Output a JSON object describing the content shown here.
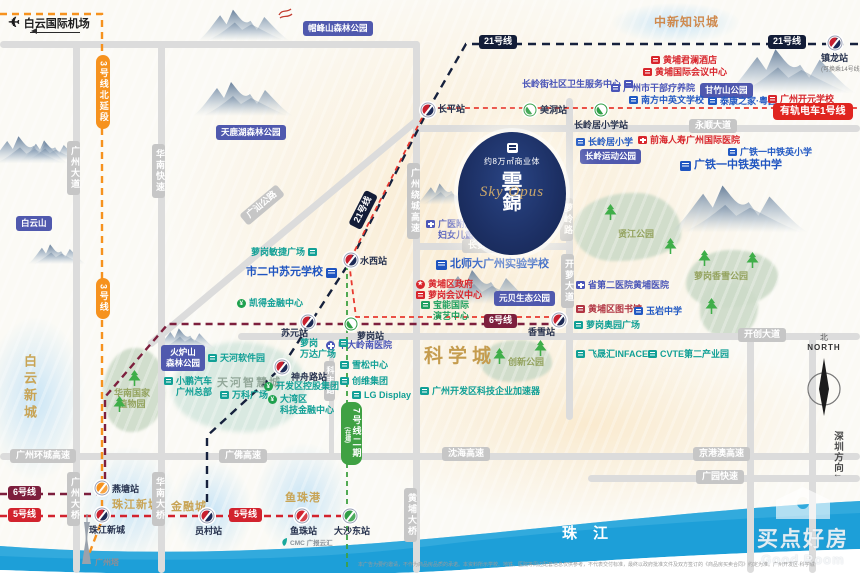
{
  "project": {
    "badge": "约8万㎡商业体",
    "name_line1": "雲",
    "name_line2": "錦",
    "name_en": "Sky Opus"
  },
  "airport": {
    "label": "白云国际机场"
  },
  "river": {
    "label": "珠江"
  },
  "compass": {
    "cn": "北",
    "en": "NORTH"
  },
  "tower": {
    "label": "广州塔"
  },
  "cmc": {
    "label": "CMC 广报云汇"
  },
  "watermark": {
    "cn": "买点好房",
    "en": "Good Room"
  },
  "disclaimer": {
    "text": "本广告为要约邀请，不作为商品房品质的承诺。本资料所示学校、地铁、医院等周边配套信息仅供参考，不代表交付标准，最终以政府批准文件及双方签订的《商品房买卖合同》约定为准。广州开发区·科学城"
  },
  "metro_lines": [
    {
      "id": "line3",
      "color": "#f6921e",
      "width": 2.4,
      "dash": "7 5",
      "points": "0,14 102,14 102,520 88,557"
    },
    {
      "id": "line6",
      "color": "#7d1f3d",
      "width": 2.4,
      "dash": "7 5",
      "points": "0,494 105,494 105,397 168,324 558,324"
    },
    {
      "id": "line5",
      "color": "#d2232e",
      "width": 2.4,
      "dash": "7 5",
      "points": "0,516 356,516"
    },
    {
      "id": "line21",
      "color": "#16213d",
      "width": 2.4,
      "dash": "8 6",
      "points": "207,516 207,436 282,367 351,260 428,110 466,44 860,44"
    },
    {
      "id": "tram1",
      "color": "#e8392f",
      "width": 1.8,
      "dash": "5 4",
      "points": "558,317 356,317 349,262 427,108 860,108"
    },
    {
      "id": "line7",
      "color": "#3fa143",
      "width": 1.8,
      "dash": "5 4",
      "points": "347,256 347,570"
    }
  ],
  "line_badges": [
    {
      "cls": "b3 vert",
      "x": 96,
      "y": 55,
      "label": "3号线北延段"
    },
    {
      "cls": "b3 vert",
      "x": 96,
      "y": 278,
      "label": "3号线"
    },
    {
      "cls": "b21",
      "x": 479,
      "y": 35,
      "label": "21号线"
    },
    {
      "cls": "b21",
      "x": 768,
      "y": 35,
      "label": "21号线"
    },
    {
      "cls": "b21",
      "x": 344,
      "y": 203,
      "label": "21号线",
      "rot": -63
    },
    {
      "cls": "b6",
      "x": 8,
      "y": 486,
      "label": "6号线"
    },
    {
      "cls": "b6",
      "x": 484,
      "y": 314,
      "label": "6号线"
    },
    {
      "cls": "b5",
      "x": 8,
      "y": 508,
      "label": "5号线"
    },
    {
      "cls": "b5",
      "x": 229,
      "y": 508,
      "label": "5号线"
    },
    {
      "cls": "btram",
      "x": 773,
      "y": 103,
      "label": "有轨电车1号线"
    },
    {
      "cls": "b7 vert",
      "x": 341,
      "y": 402,
      "label": "7号线二期",
      "label2": "(在建)"
    }
  ],
  "stations": [
    {
      "cls": "st-m",
      "x": 428,
      "y": 110,
      "label": "长平站",
      "ldx": 10,
      "ldy": -8,
      "fs": 10
    },
    {
      "cls": "st-tram",
      "x": 530,
      "y": 110,
      "label": "美洞站",
      "ldx": 10,
      "ldy": -7
    },
    {
      "cls": "st-tram",
      "x": 601,
      "y": 110,
      "label": "长岭居小学站",
      "ldx": -27,
      "ldy": 8
    },
    {
      "cls": "st-m",
      "x": 835,
      "y": 43,
      "label": "镇龙站",
      "label2": "(可换乘14号线)",
      "ldx": -14,
      "ldy": 8
    },
    {
      "cls": "st-m",
      "x": 351,
      "y": 260,
      "label": "水西站",
      "ldx": 9,
      "ldy": -6
    },
    {
      "cls": "st-m",
      "x": 308,
      "y": 322,
      "label": "苏元站",
      "ldx": -27,
      "ldy": 4
    },
    {
      "cls": "st-tram",
      "x": 351,
      "y": 324,
      "label": "萝岗站",
      "ldx": 6,
      "ldy": 5
    },
    {
      "cls": "st-m",
      "x": 559,
      "y": 320,
      "label": "香雪站",
      "ldx": -31,
      "ldy": 5
    },
    {
      "cls": "st-m",
      "x": 282,
      "y": 367,
      "label": "神舟路站",
      "ldx": 9,
      "ldy": 3
    },
    {
      "cls": "st-o",
      "x": 102,
      "y": 488,
      "label": "燕塘站",
      "ldx": 10,
      "ldy": -6
    },
    {
      "cls": "st-m",
      "x": 102,
      "y": 515,
      "label": "珠江新城",
      "ldx": -13,
      "ldy": 8
    },
    {
      "cls": "st-m",
      "x": 207,
      "y": 516,
      "label": "员村站",
      "ldx": -12,
      "ldy": 8
    },
    {
      "cls": "st-r",
      "x": 302,
      "y": 516,
      "label": "鱼珠站",
      "ldx": -12,
      "ldy": 8
    },
    {
      "cls": "st-g",
      "x": 350,
      "y": 516,
      "label": "大沙东站",
      "ldx": -16,
      "ldy": 8
    }
  ],
  "pois": [
    {
      "cls": "k-hosp ic-bld",
      "x": 522,
      "y": 79,
      "label": "长岭街社区卫生服务中心",
      "rev": 1
    },
    {
      "cls": "k-red ic-bld",
      "x": 651,
      "y": 55,
      "label": "黄埔君澜酒店"
    },
    {
      "cls": "k-red ic-bld",
      "x": 643,
      "y": 67,
      "label": "黄埔国际会议中心"
    },
    {
      "cls": "k-hosp ic-bld",
      "x": 611,
      "y": 83,
      "label": "广州市干部疗养院"
    },
    {
      "cls": "k-school ic-bld",
      "x": 629,
      "y": 95,
      "label": "南方中英文学校"
    },
    {
      "cls": "k-school ic-bld",
      "x": 708,
      "y": 96,
      "label": "泰康之家·粤园"
    },
    {
      "cls": "k-red ic-bld",
      "x": 768,
      "y": 94,
      "label": "广州开元学校"
    },
    {
      "cls": "k-school ic-bld",
      "x": 576,
      "y": 137,
      "label": "长岭居小学"
    },
    {
      "cls": "k-red ic-cross",
      "x": 638,
      "y": 135,
      "label": "前海人寿广州国际医院"
    },
    {
      "cls": "k-school ic-bld",
      "x": 728,
      "y": 147,
      "label": "广铁一中铁英小学"
    },
    {
      "cls": "k-school2 ic-bld",
      "x": 680,
      "y": 159,
      "label": "广铁一中铁英中学"
    },
    {
      "cls": "k-hosp ic-cross",
      "x": 426,
      "y": 219,
      "label": "广医附属",
      "label2": "妇女儿童医院"
    },
    {
      "cls": "k-school2 ic-bld",
      "x": 436,
      "y": 258,
      "label": "北师大广州实验学校"
    },
    {
      "cls": "k-biz ic-bld",
      "x": 251,
      "y": 247,
      "label": "萝岗敏捷广场",
      "rev": 1
    },
    {
      "cls": "k-school2 ic-bld",
      "x": 246,
      "y": 266,
      "label": "市二中苏元学校",
      "rev": 1
    },
    {
      "cls": "k-fin ic-yen",
      "x": 237,
      "y": 298,
      "label": "凯得金融中心"
    },
    {
      "cls": "k-red ic-star",
      "x": 416,
      "y": 279,
      "label": "黄埔区政府"
    },
    {
      "cls": "k-red ic-bld",
      "x": 416,
      "y": 290,
      "label": "萝岗会议中心"
    },
    {
      "cls": "k-green2 ic-bld",
      "x": 421,
      "y": 300,
      "label": "宝能国际",
      "label2": "演艺中心"
    },
    {
      "cls": "k-hosp ic-crossr",
      "x": 326,
      "y": 340,
      "label": "中大岭南医院"
    },
    {
      "cls": "k-biz ic-bld",
      "x": 340,
      "y": 360,
      "label": "雪松中心"
    },
    {
      "cls": "k-biz ic-bld",
      "x": 340,
      "y": 376,
      "label": "创维集团"
    },
    {
      "cls": "k-biz ic-bld",
      "x": 352,
      "y": 390,
      "label": "LG Display"
    },
    {
      "cls": "k-biz ic-bld",
      "x": 420,
      "y": 386,
      "label": "广州开发区科技企业加速器"
    },
    {
      "cls": "k-biz ic-bld",
      "x": 300,
      "y": 338,
      "label": "萝岗",
      "label2": "万达广场",
      "rev": 1
    },
    {
      "cls": "k-biz ic-bld",
      "x": 208,
      "y": 353,
      "label": "天河软件园"
    },
    {
      "cls": "k-biz ic-bld",
      "x": 164,
      "y": 376,
      "label": "小鹏汽车",
      "label2": "广州总部"
    },
    {
      "cls": "k-biz ic-bld",
      "x": 220,
      "y": 390,
      "label": "万科广场"
    },
    {
      "cls": "k-fin ic-yen",
      "x": 264,
      "y": 381,
      "label": "开发区控股集团"
    },
    {
      "cls": "k-fin ic-yen",
      "x": 268,
      "y": 394,
      "label": "大湾区",
      "label2": "科技金融中心"
    },
    {
      "cls": "k-hosp ic-cross",
      "x": 576,
      "y": 280,
      "label": "省第二医院黄埔医院"
    },
    {
      "cls": "k-lib ic-bld",
      "x": 576,
      "y": 304,
      "label": "黄埔区图书馆"
    },
    {
      "cls": "k-school ic-bld",
      "x": 634,
      "y": 306,
      "label": "玉岩中学"
    },
    {
      "cls": "k-biz ic-bld",
      "x": 574,
      "y": 320,
      "label": "萝岗奥园广场"
    },
    {
      "cls": "k-biz ic-bld",
      "x": 576,
      "y": 349,
      "label": "飞晟汇INFACE"
    },
    {
      "cls": "k-biz ic-bld",
      "x": 648,
      "y": 349,
      "label": "CVTE第二产业园"
    }
  ],
  "park_badges": [
    {
      "x": 303,
      "y": 21,
      "label": "帽峰山森林公园"
    },
    {
      "x": 216,
      "y": 125,
      "label": "天鹿湖森林公园"
    },
    {
      "x": 16,
      "y": 216,
      "label": "白云山"
    },
    {
      "x": 161,
      "y": 345,
      "label": "火炉山",
      "label2": "森林公园"
    },
    {
      "x": 700,
      "y": 83,
      "label": "甘竹山公园"
    },
    {
      "x": 580,
      "y": 149,
      "label": "长岭运动公园"
    },
    {
      "x": 494,
      "y": 291,
      "label": "元贝生态公园"
    }
  ],
  "park_labels": [
    {
      "x": 618,
      "y": 229,
      "label": "贤江公园"
    },
    {
      "x": 694,
      "y": 271,
      "label": "萝岗香雪公园"
    },
    {
      "x": 508,
      "y": 357,
      "label": "创新公园"
    },
    {
      "x": 114,
      "y": 388,
      "label": "华南国家",
      "label2": "植物园"
    }
  ],
  "regions": [
    {
      "x": 654,
      "y": 13,
      "label": "中新知识城",
      "fs": 12,
      "ls": 1,
      "color": "#cf8a4e"
    },
    {
      "x": 424,
      "y": 341,
      "label": "科学城",
      "fs": 19,
      "ls": 5,
      "color": "#c59c4e"
    },
    {
      "x": 20,
      "y": 354,
      "label": "白云新城",
      "fs": 13,
      "ls": 4,
      "color": "#c8a455",
      "cls": "vert"
    },
    {
      "x": 112,
      "y": 496,
      "label": "珠江新城",
      "fs": 11,
      "ls": 1,
      "color": "#c8a455"
    },
    {
      "x": 171,
      "y": 498,
      "label": "金融城",
      "fs": 11,
      "ls": 1,
      "color": "#c8a455"
    },
    {
      "x": 285,
      "y": 489,
      "label": "鱼珠港",
      "fs": 11,
      "ls": 1,
      "color": "#c8a455"
    },
    {
      "x": 217,
      "y": 374,
      "label": "天河智慧城",
      "fs": 11,
      "ls": 2,
      "color": "#93a89a"
    }
  ],
  "road_badges": [
    {
      "x": 689,
      "y": 119,
      "label": "永顺大道"
    },
    {
      "x": 462,
      "y": 239,
      "label": "长贤路"
    },
    {
      "x": 738,
      "y": 328,
      "label": "开创大道"
    },
    {
      "x": 10,
      "y": 449,
      "label": "广州环城高速"
    },
    {
      "x": 219,
      "y": 449,
      "label": "广佛高速"
    },
    {
      "x": 442,
      "y": 447,
      "label": "沈海高速"
    },
    {
      "x": 693,
      "y": 447,
      "label": "京港澳高速"
    },
    {
      "x": 696,
      "y": 470,
      "label": "广园快速"
    },
    {
      "x": 238,
      "y": 198,
      "label": "广汕公路",
      "rot": -40
    }
  ],
  "road_vlabels": [
    {
      "x": 67,
      "y": 141,
      "label": "广州大道"
    },
    {
      "x": 152,
      "y": 144,
      "label": "华南快速"
    },
    {
      "x": 407,
      "y": 163,
      "label": "广州绕城高速"
    },
    {
      "x": 560,
      "y": 198,
      "label": "萝岭路"
    },
    {
      "x": 561,
      "y": 254,
      "label": "开萝大道"
    },
    {
      "x": 324,
      "y": 361,
      "label": "科丰路",
      "cls": "sm"
    },
    {
      "x": 404,
      "y": 488,
      "label": "黄埔大桥"
    },
    {
      "x": 67,
      "y": 472,
      "label": "广州大桥"
    },
    {
      "x": 152,
      "y": 472,
      "label": "华南大桥"
    },
    {
      "x": 830,
      "y": 426,
      "label": "深圳方向↓",
      "cls": "dir"
    }
  ],
  "roads_h": [
    {
      "x": 0,
      "y": 41,
      "w": 420
    },
    {
      "x": 413,
      "y": 125,
      "w": 447
    },
    {
      "x": 413,
      "y": 243,
      "w": 160
    },
    {
      "x": 238,
      "y": 333,
      "w": 622
    },
    {
      "x": 0,
      "y": 453,
      "w": 860
    },
    {
      "x": 588,
      "y": 475,
      "w": 272
    }
  ],
  "roads_v": [
    {
      "x": 73,
      "y": 41,
      "h": 532
    },
    {
      "x": 158,
      "y": 41,
      "h": 532
    },
    {
      "x": 413,
      "y": 41,
      "h": 532
    },
    {
      "x": 566,
      "y": 98,
      "h": 322
    },
    {
      "x": 747,
      "y": 333,
      "h": 240
    },
    {
      "x": 809,
      "y": 333,
      "h": 240
    },
    {
      "x": 329,
      "y": 336,
      "h": 120,
      "w": 5
    }
  ],
  "roads_d": [
    {
      "x": 418,
      "y": 116,
      "w": 352,
      "rot": 140
    }
  ],
  "blobs": [
    {
      "cls": "blob-warm",
      "x": 165,
      "y": -15,
      "w": 620,
      "h": 460
    },
    {
      "cls": "blob-warm",
      "x": 350,
      "y": 330,
      "w": 480,
      "h": 190
    },
    {
      "cls": "blob-blue",
      "x": 612,
      "y": 3,
      "w": 128,
      "h": 40
    },
    {
      "cls": "blob-blue",
      "x": -15,
      "y": 318,
      "w": 100,
      "h": 162
    },
    {
      "cls": "blob-blue",
      "x": 78,
      "y": 447,
      "w": 100,
      "h": 116
    },
    {
      "cls": "blob-blue",
      "x": 172,
      "y": 460,
      "w": 80,
      "h": 100
    },
    {
      "cls": "blob-blue",
      "x": 255,
      "y": 443,
      "w": 96,
      "h": 112
    },
    {
      "cls": "blob-green",
      "x": 573,
      "y": 193,
      "w": 108,
      "h": 68,
      "br": "58% 42% 62% 38%/55% 60% 40% 50%"
    },
    {
      "cls": "blob-green",
      "x": 686,
      "y": 250,
      "w": 92,
      "h": 58,
      "br": "50% 50% 60% 40%/60% 45% 55% 42%"
    },
    {
      "cls": "blob-green",
      "x": 700,
      "y": 282,
      "w": 58,
      "h": 56,
      "br": "45% 55% 50% 50%/50% 45% 60% 48%"
    },
    {
      "cls": "blob-green",
      "x": 480,
      "y": 340,
      "w": 72,
      "h": 42,
      "br": "55% 45% 58% 42%/52% 58% 45% 52%"
    },
    {
      "cls": "blob-green",
      "x": 103,
      "y": 348,
      "w": 62,
      "h": 84,
      "br": "52% 48% 55% 45%/58% 45% 52% 46%"
    },
    {
      "cls": "blob-teal",
      "x": 172,
      "y": 342,
      "w": 135,
      "h": 90,
      "br": "50% 50% 45% 55%/55% 50% 50% 45%"
    }
  ],
  "trees": [
    {
      "x": 604,
      "y": 204
    },
    {
      "x": 664,
      "y": 238
    },
    {
      "x": 698,
      "y": 250
    },
    {
      "x": 746,
      "y": 252
    },
    {
      "x": 705,
      "y": 298
    },
    {
      "x": 493,
      "y": 348
    },
    {
      "x": 534,
      "y": 340
    },
    {
      "x": 128,
      "y": 370
    },
    {
      "x": 113,
      "y": 396
    }
  ],
  "mountains": [
    {
      "x": 193,
      "y": 78,
      "s": 1.0
    },
    {
      "x": 198,
      "y": 6,
      "s": 0.92
    },
    {
      "x": 726,
      "y": 44,
      "s": 1.3
    },
    {
      "x": -12,
      "y": 133,
      "s": 0.8
    },
    {
      "x": 22,
      "y": 138,
      "s": 0.58
    },
    {
      "x": 28,
      "y": 242,
      "s": 0.58
    },
    {
      "x": 416,
      "y": 181,
      "s": 0.62
    },
    {
      "x": 434,
      "y": 266,
      "s": 1.0
    },
    {
      "x": 670,
      "y": 180,
      "s": 1.38
    },
    {
      "x": 156,
      "y": 326,
      "s": 0.6
    }
  ]
}
